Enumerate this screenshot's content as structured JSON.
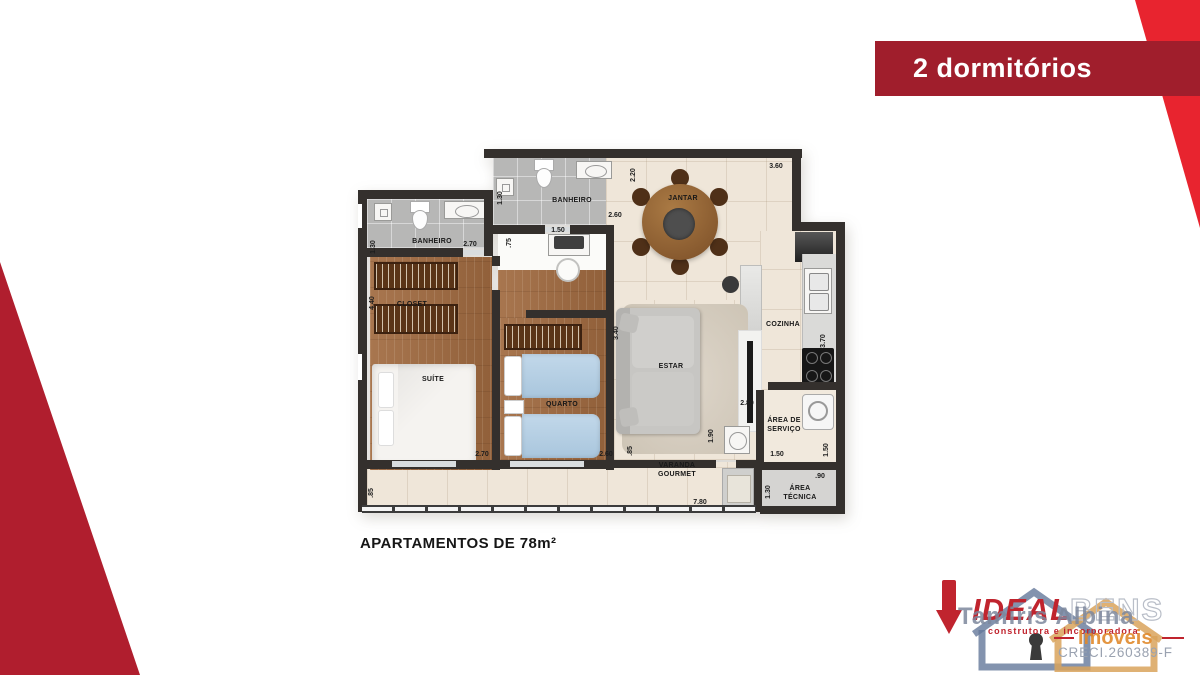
{
  "banner": {
    "label": "2 dormitórios",
    "bg": "#A01E2C",
    "accent_red": "#E8242F",
    "corner_red": "#B01E2E"
  },
  "caption": "APARTAMENTOS DE 78m²",
  "plan": {
    "rooms": {
      "banheiro_suite": "BANHEIRO",
      "banheiro_social": "BANHEIRO",
      "jantar": "JANTAR",
      "cozinha": "COZINHA",
      "estar": "ESTAR",
      "closet": "CLOSET",
      "suite": "SUÍTE",
      "quarto": "QUARTO",
      "varanda_line1": "VARANDA",
      "varanda_line2": "GOURMET",
      "servico_line1": "ÁREA DE",
      "servico_line2": "SERVIÇO",
      "tecnica_line1": "ÁREA",
      "tecnica_line2": "TÉCNICA"
    },
    "dims": {
      "suite_bath_w": "1.30",
      "suite_bath_l": "2.70",
      "bath2_w": "1.30",
      "bath2_l": "2.60",
      "hall_w": ".75",
      "hall_l": "1.50",
      "jantar_w": "2.20",
      "jantar_l": "3.60",
      "cozinha_h": "3.70",
      "estar_w": "2.80",
      "closet_h": "4.40",
      "suite_l": "2.70",
      "quarto_l": "2.60",
      "quarto_h": "3.40",
      "quarto_r": ".85",
      "varanda_left": ".85",
      "varanda_l": "7.80",
      "varanda_sink": "1.90",
      "servico_l": "1.50",
      "servico_r": "1.50",
      "tecnica_w": "1.30",
      "tecnica_t": ".90"
    },
    "wall_color": "#34302D"
  },
  "logo": {
    "brand_primary": "IDEAL",
    "brand_secondary": "BENS",
    "realtor": "Tamiris Albina",
    "tagline": "construtora e incorporadora",
    "segment": "Imóveis",
    "license": "CRECI.260389-F"
  }
}
